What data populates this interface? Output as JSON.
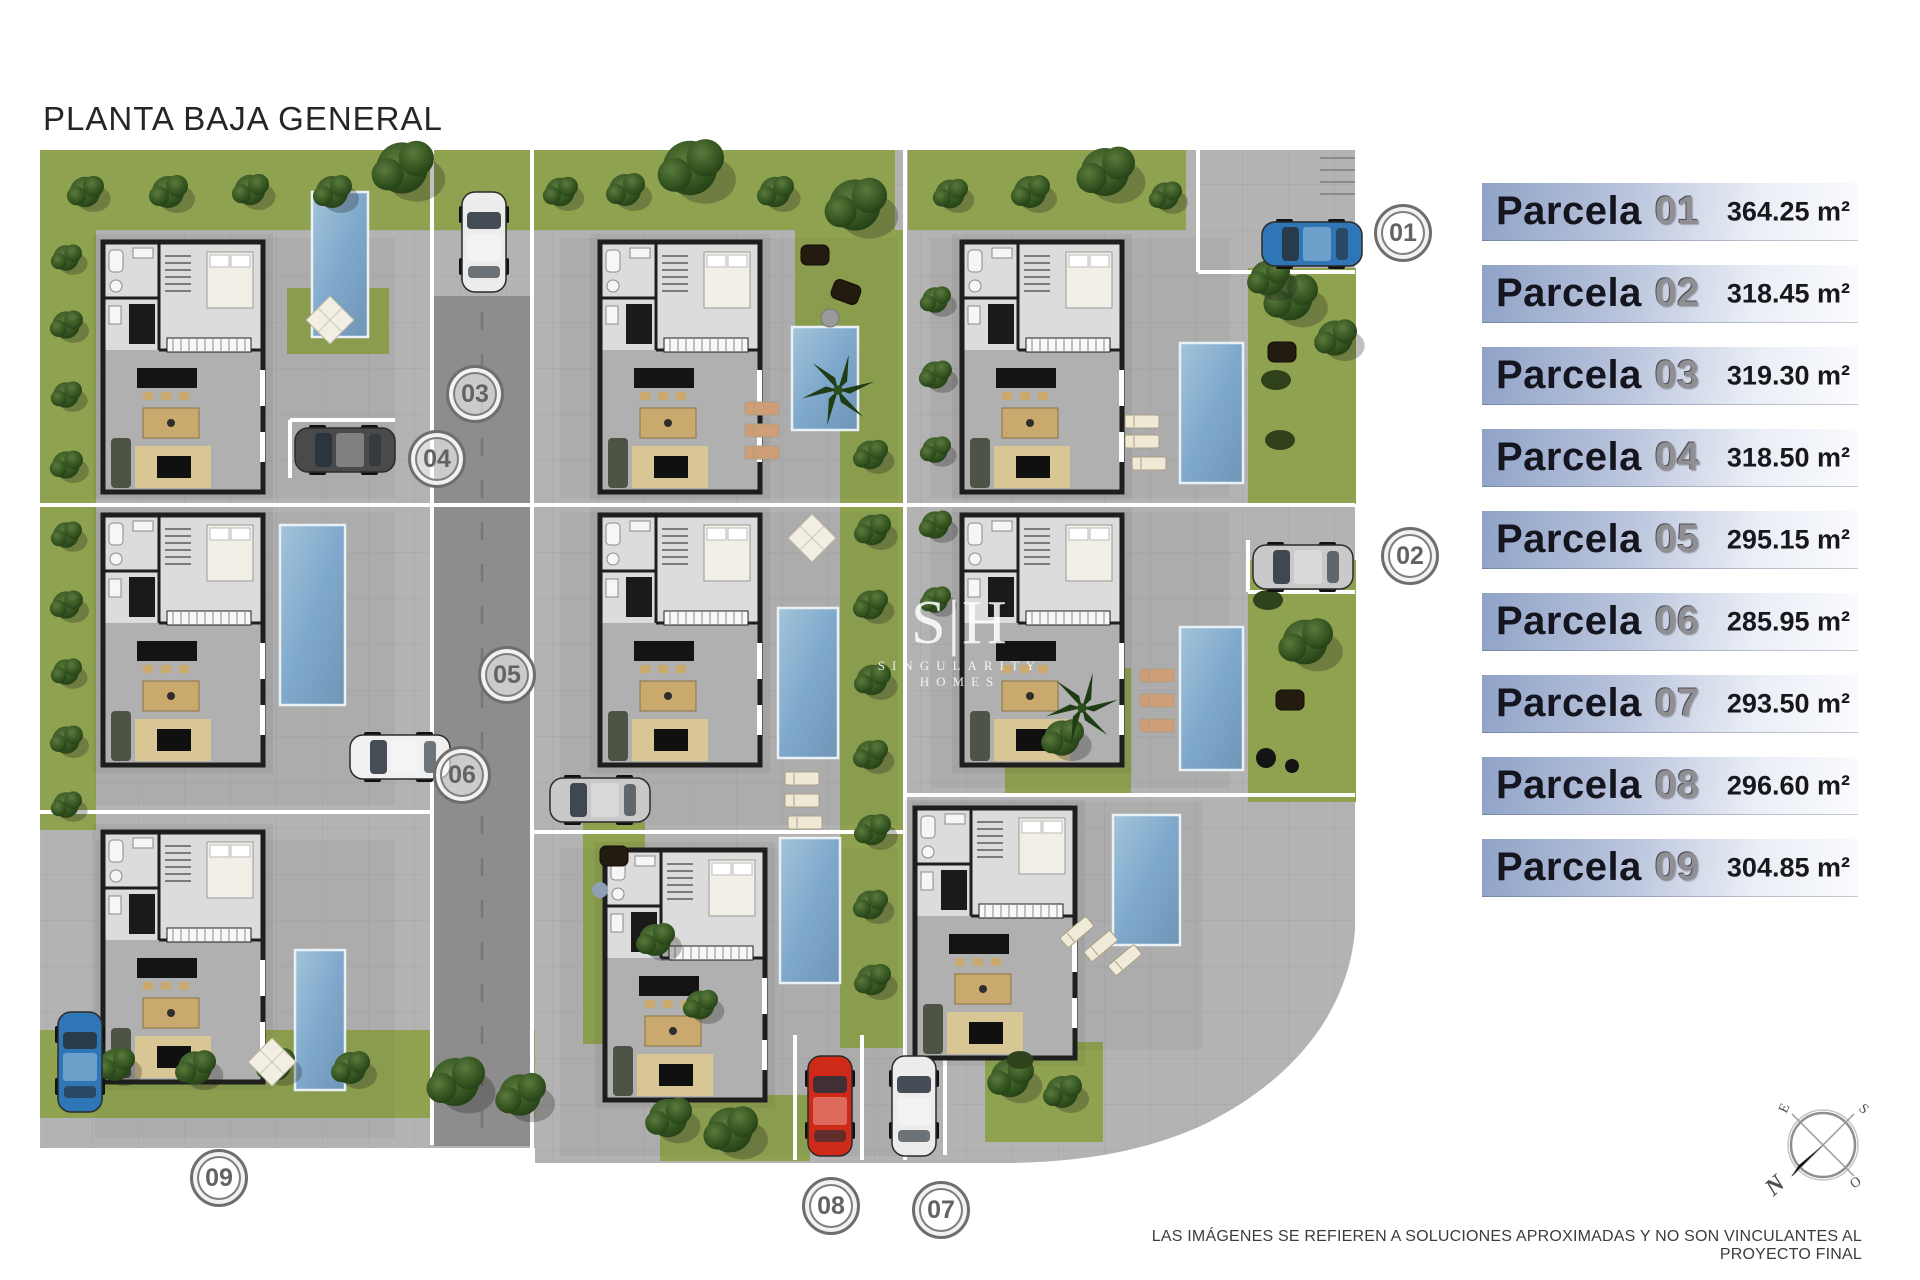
{
  "title": "PLANTA BAJA GENERAL",
  "legend": {
    "items": [
      {
        "label": "Parcela",
        "number": "01",
        "area": "364.25 m²"
      },
      {
        "label": "Parcela",
        "number": "02",
        "area": "318.45 m²"
      },
      {
        "label": "Parcela",
        "number": "03",
        "area": "319.30 m²"
      },
      {
        "label": "Parcela",
        "number": "04",
        "area": "318.50 m²"
      },
      {
        "label": "Parcela",
        "number": "05",
        "area": "295.15 m²"
      },
      {
        "label": "Parcela",
        "number": "06",
        "area": "285.95 m²"
      },
      {
        "label": "Parcela",
        "number": "07",
        "area": "293.50 m²"
      },
      {
        "label": "Parcela",
        "number": "08",
        "area": "296.60 m²"
      },
      {
        "label": "Parcela",
        "number": "09",
        "area": "304.85 m²"
      }
    ]
  },
  "site_plan": {
    "markers": [
      {
        "id": "01"
      },
      {
        "id": "02"
      },
      {
        "id": "03"
      },
      {
        "id": "04"
      },
      {
        "id": "05"
      },
      {
        "id": "06"
      },
      {
        "id": "07"
      },
      {
        "id": "08"
      },
      {
        "id": "09"
      }
    ],
    "watermark": {
      "logo": "S|H",
      "name": "SINGULARITY HOMES"
    }
  },
  "compass": {
    "n": "N",
    "e": "E",
    "s": "S",
    "o": "O"
  },
  "disclaimer": "LAS IMÁGENES SE REFIEREN A SOLUCIONES APROXIMADAS Y NO SON VINCULANTES AL PROYECTO FINAL",
  "colors": {
    "paving": "#b3b3b3",
    "road": "#8d8d8d",
    "grass": "#8fa24f",
    "pool": "#7fa9cc",
    "legend_blue": "#96a7cb",
    "marker_ring": "#6e6e6e"
  }
}
